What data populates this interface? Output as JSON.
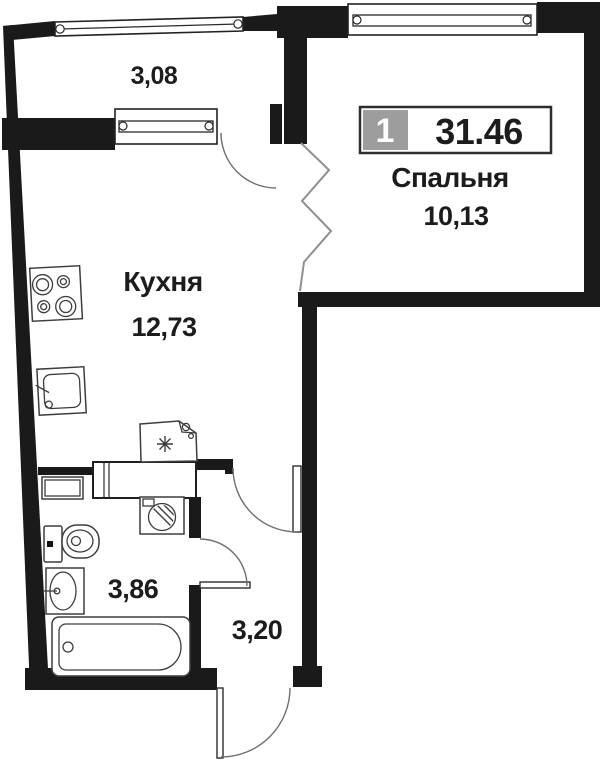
{
  "unit": {
    "badge": "1",
    "total_area": "31.46"
  },
  "rooms": {
    "bedroom": {
      "name": "Спальня",
      "area": "10,13"
    },
    "kitchen": {
      "name": "Кухня",
      "area": "12,73"
    },
    "balcony": {
      "area": "3,08"
    },
    "bathroom": {
      "area": "3,86"
    },
    "hallway": {
      "area": "3,20"
    }
  },
  "colors": {
    "wall": "#1a1a1a",
    "badge_bg": "#9d9d9d",
    "badge_text": "#ffffff",
    "text": "#1c1c1c",
    "background": "#ffffff"
  }
}
